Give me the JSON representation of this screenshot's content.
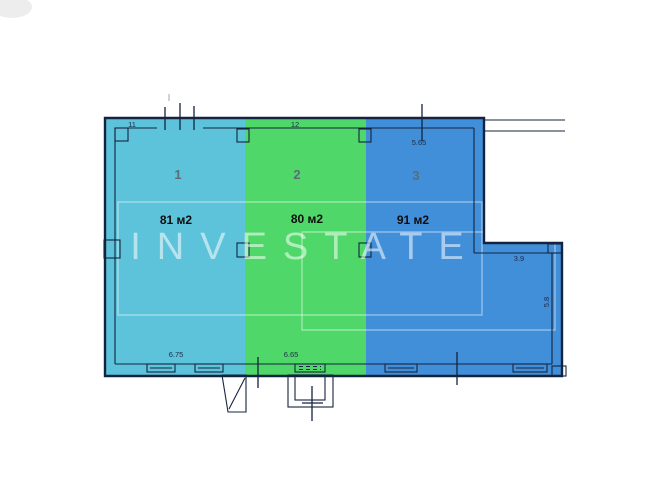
{
  "title": "Floor plan",
  "watermark": "INVESTATE",
  "sections": [
    {
      "number": "1",
      "area": "81 м2",
      "color": "#5cc3db"
    },
    {
      "number": "2",
      "area": "80 м2",
      "color": "#4fd869"
    },
    {
      "number": "3",
      "area": "91 м2",
      "color": "#418ed9"
    }
  ],
  "dimensions": {
    "top_section1": "11",
    "top_section2": "12",
    "top_section3": "5.65",
    "bottom_section1": "6.75",
    "bottom_section2": "6.65",
    "right_ledge": "3.9",
    "right_wall": "5.8"
  },
  "colors": {
    "wall": "#15243e",
    "background": "#ffffff"
  }
}
